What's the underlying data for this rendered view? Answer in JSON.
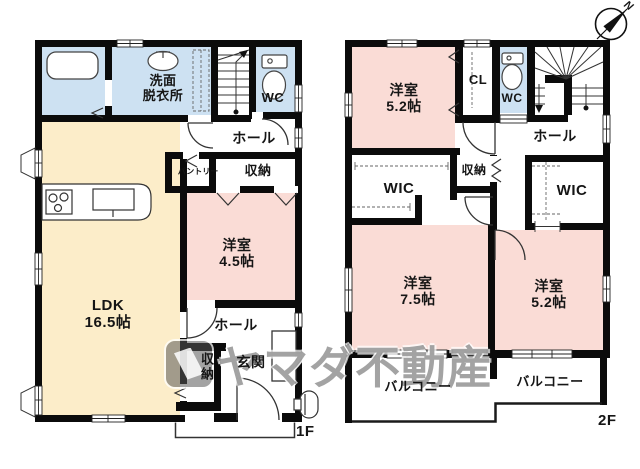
{
  "watermark": {
    "text": "ヤマダ不動産"
  },
  "compass": {
    "north_label": "N"
  },
  "colors": {
    "room_pink": "#fadcd6",
    "room_cream": "#fcedc9",
    "room_blue": "#cde1f2",
    "wall": "#0b0b0b"
  },
  "floor1": {
    "floor_label": "1F",
    "rooms": {
      "washroom": {
        "line1": "洗面",
        "line2": "脱衣所"
      },
      "wc": {
        "label": "WC"
      },
      "hall_upper": {
        "label": "ホール"
      },
      "pantry": {
        "label": "パントリー"
      },
      "closet_upper": {
        "label": "収納"
      },
      "western_room": {
        "label": "洋室",
        "size": "4.5帖"
      },
      "ldk": {
        "label": "LDK",
        "size": "16.5帖"
      },
      "hall_lower": {
        "label": "ホール"
      },
      "closet_lower": {
        "label": "収納"
      },
      "entrance": {
        "label": "玄関"
      }
    }
  },
  "floor2": {
    "floor_label": "2F",
    "rooms": {
      "western_room_a": {
        "label": "洋室",
        "size": "5.2帖"
      },
      "cl": {
        "label": "CL"
      },
      "wc": {
        "label": "WC"
      },
      "hall": {
        "label": "ホール"
      },
      "wic_left": {
        "label": "WIC"
      },
      "closet": {
        "label": "収納"
      },
      "wic_right": {
        "label": "WIC"
      },
      "western_room_b": {
        "label": "洋室",
        "size": "7.5帖"
      },
      "western_room_c": {
        "label": "洋室",
        "size": "5.2帖"
      },
      "balcony_left": {
        "label": "バルコニー"
      },
      "balcony_right": {
        "label": "バルコニー"
      }
    }
  }
}
